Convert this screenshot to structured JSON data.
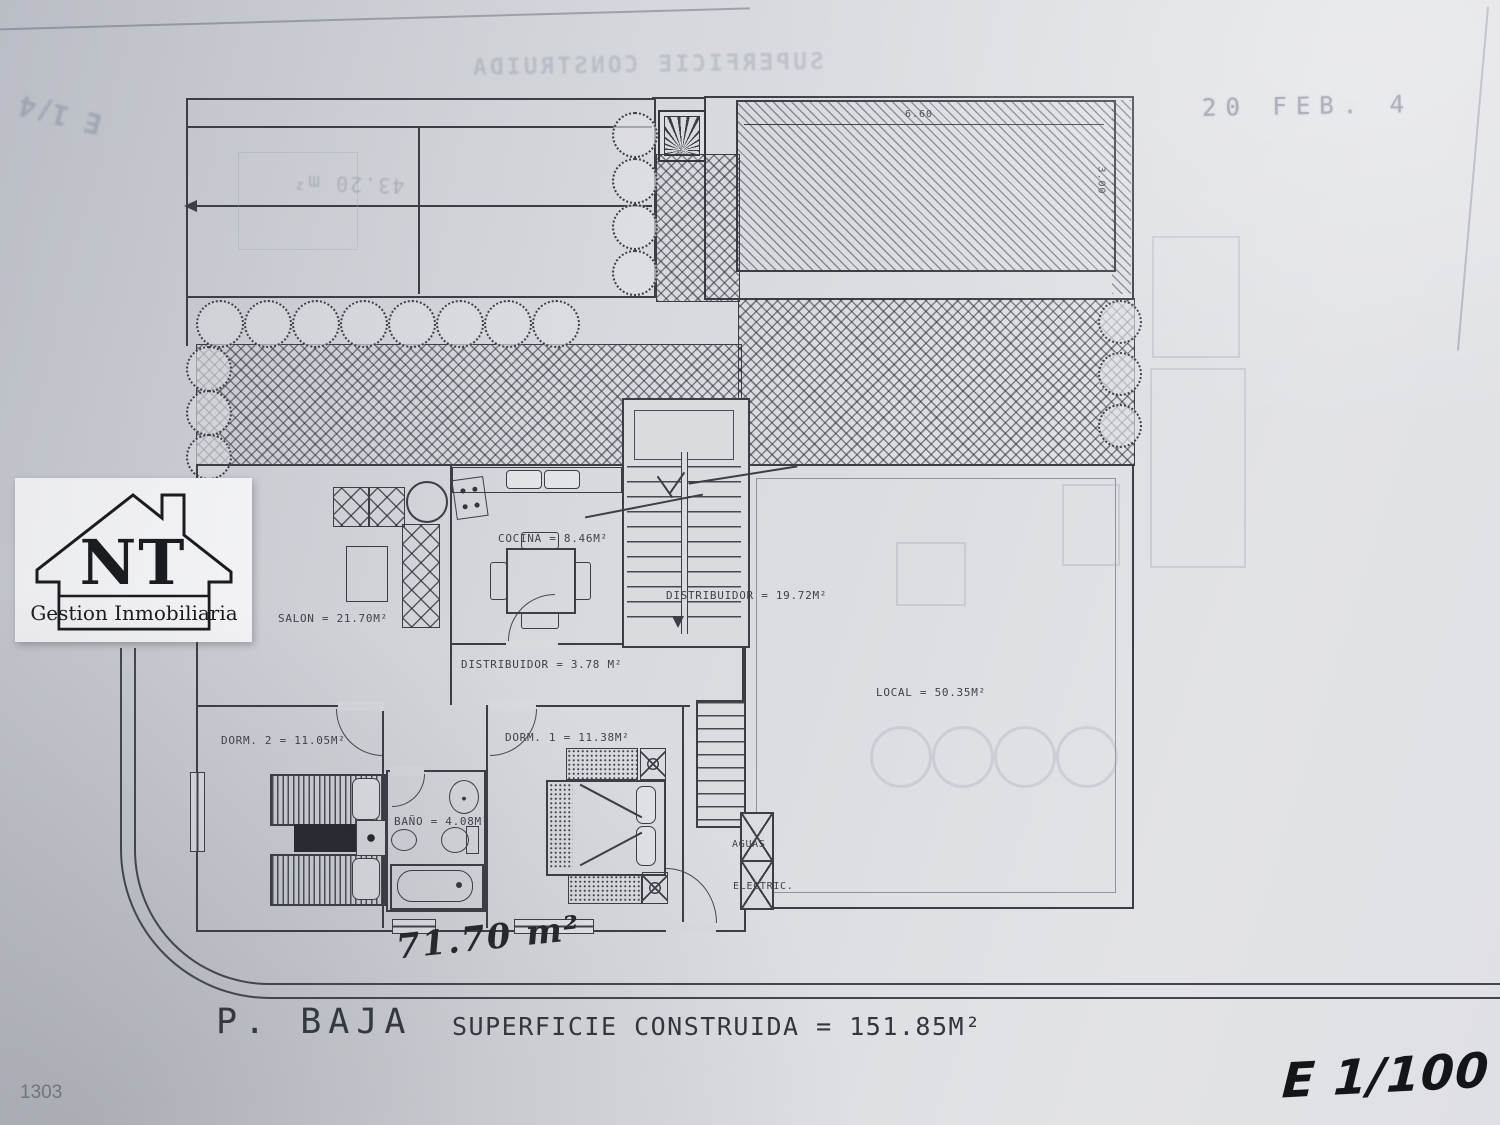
{
  "document": {
    "date_stamp": "20 FEB.  4",
    "sheet_number": "1303",
    "floor_title": "P. BAJA",
    "built_area": "SUPERFICIE CONSTRUIDA = 151.85M²",
    "handwritten_area": "71.70 m²",
    "handwritten_scale": "E 1/100"
  },
  "logo": {
    "initials": "NT",
    "subtitle": "Gestion Inmobiliaria"
  },
  "rooms": {
    "salon": "SALON = 21.70M²",
    "cocina": "COCINA = 8.46M²",
    "distribuidor_main": "DISTRIBUIDOR = 19.72M²",
    "distribuidor_hall": "DISTRIBUIDOR = 3.78 M²",
    "dorm2": "DORM. 2 = 11.05M²",
    "dorm1": "DORM. 1 = 11.38M²",
    "bano": "BAÑO = 4.08M²",
    "local": "LOCAL = 50.35M²",
    "aguas": "AGUAS",
    "electric": "ELECTRIC."
  },
  "pool": {
    "width": "6.60",
    "depth": "3.00"
  },
  "showthrough": {
    "header": "SUPERFICIE CONSTRUIDA",
    "garage_area": "43.20 m²",
    "corner_scale": "E 1/4"
  }
}
